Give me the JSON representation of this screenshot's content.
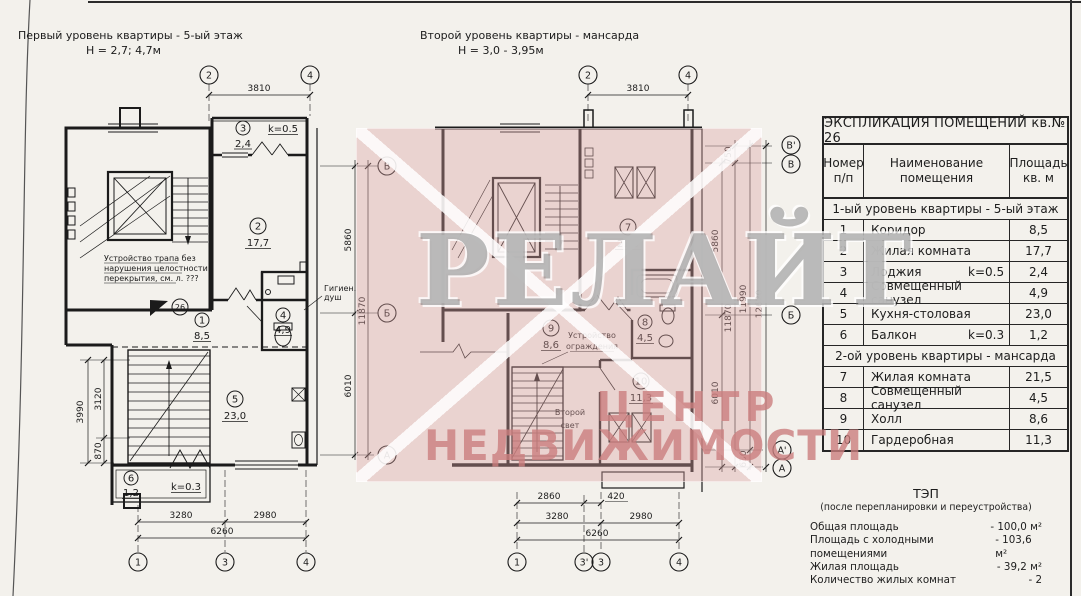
{
  "left_plan": {
    "title": "Первый уровень квартиры - 5-ый этаж",
    "height": "Н = 2,7; 4,7м",
    "grid": {
      "top": [
        "2",
        "4"
      ],
      "right": [
        "В",
        "Б",
        "А"
      ],
      "bottom": [
        "1",
        "3",
        "4"
      ]
    },
    "dims": {
      "top": "3810",
      "v5860": "5860",
      "v6010": "6010",
      "v_total": "11870",
      "l_outer": "3990",
      "l1": "3120",
      "l2": "870",
      "b1": "3280",
      "b2": "2980",
      "b_total": "6260"
    },
    "rooms": {
      "r1": {
        "num": "1",
        "area": "8,5"
      },
      "r2": {
        "num": "2",
        "area": "17,7"
      },
      "r3": {
        "num": "3",
        "area": "2,4",
        "coef": "k=0.5"
      },
      "r4": {
        "num": "4",
        "area": "4,9"
      },
      "r5": {
        "num": "5",
        "area": "23,0"
      },
      "r6": {
        "num": "6",
        "area": "1,2",
        "coef": "k=0.3"
      }
    },
    "door_number": "26",
    "note_trap": [
      "Устройство трапа без",
      "нарушения целостности",
      "перекрытия, см. л. ???"
    ],
    "note_shower": [
      "Гигиен.",
      "душ"
    ]
  },
  "right_plan": {
    "title": "Второй уровень квартиры - мансарда",
    "height": "Н = 3,0 - 3,95м",
    "grid": {
      "top": [
        "2",
        "4"
      ],
      "right": [
        "В'",
        "В",
        "Б",
        "А'",
        "А"
      ],
      "bottom": [
        "1",
        "3'",
        "3",
        "4"
      ]
    },
    "dims": {
      "top": "3810",
      "v750": "750",
      "v5860": "5860",
      "v6010": "6010",
      "v630": "630",
      "v11870": "11870",
      "v11990": "11990",
      "v12620": "12620",
      "b1": "2860",
      "b2": "420",
      "b3": "3280",
      "b4": "2980",
      "b_total": "6260"
    },
    "rooms": {
      "r7": {
        "num": "7",
        "area": "21,5"
      },
      "r8": {
        "num": "8",
        "area": "4,5"
      },
      "r9": {
        "num": "9",
        "area": "8,6"
      },
      "r10": {
        "num": "10",
        "area": "11,3"
      }
    },
    "note_fence": [
      "Устройство",
      "ограждения"
    ],
    "note_light": [
      "Второй",
      "свет"
    ]
  },
  "table": {
    "title": "ЭКСПЛИКАЦИЯ ПОМЕЩЕНИЙ кв.№ 26",
    "col_num": [
      "Номер",
      "п/п"
    ],
    "col_name": [
      "Наименование",
      "помещения"
    ],
    "col_area": [
      "Площадь",
      "кв. м"
    ],
    "section1": "1-ый уровень квартиры - 5-ый этаж",
    "section2": "2-ой уровень квартиры - мансарда",
    "rows1": [
      {
        "n": "1",
        "name": "Коридор",
        "coef": "",
        "area": "8,5"
      },
      {
        "n": "2",
        "name": "Жилая комната",
        "coef": "",
        "area": "17,7"
      },
      {
        "n": "3",
        "name": "Лоджия",
        "coef": "k=0.5",
        "area": "2,4"
      },
      {
        "n": "4",
        "name": "Совмещенный санузел",
        "coef": "",
        "area": "4,9"
      },
      {
        "n": "5",
        "name": "Кухня-столовая",
        "coef": "",
        "area": "23,0"
      },
      {
        "n": "6",
        "name": "Балкон",
        "coef": "k=0.3",
        "area": "1,2"
      }
    ],
    "rows2": [
      {
        "n": "7",
        "name": "Жилая комната",
        "coef": "",
        "area": "21,5"
      },
      {
        "n": "8",
        "name": "Совмещенный санузел",
        "coef": "",
        "area": "4,5"
      },
      {
        "n": "9",
        "name": "Холл",
        "coef": "",
        "area": "8,6"
      },
      {
        "n": "10",
        "name": "Гардеробная",
        "coef": "",
        "area": "11,3"
      }
    ]
  },
  "tep": {
    "title": "ТЭП",
    "subtitle": "(после перепланировки и переустройства)",
    "items": [
      {
        "label": "Общая площадь",
        "value": "- 100,0 м²"
      },
      {
        "label": "Площадь с холодными помещениями",
        "value": "- 103,6 м²"
      },
      {
        "label": "Жилая площадь",
        "value": "- 39,2 м²"
      },
      {
        "label": "Количество жилых комнат",
        "value": "-  2"
      }
    ]
  },
  "watermark": {
    "brand": "РЕЛАЙТ",
    "line1": "ЦЕНТР",
    "line2": "НЕДВИЖИМОСТИ",
    "pink": "#dda4a4"
  }
}
